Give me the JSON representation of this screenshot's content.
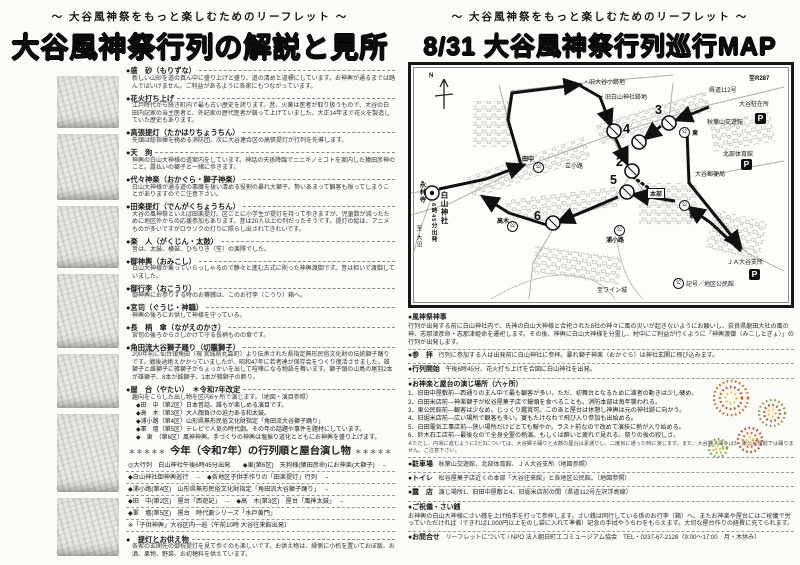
{
  "tagline": "～ 大谷風神祭をもっと楽しむためのリーフレット ～",
  "left_page": {
    "title": "大谷風神祭行列の解説と見所",
    "items": [
      {
        "h": "●盛　砂（もりずな）",
        "b": "新しい山砂を道の真ん中に盛り上げと盛り、道の清めと道標にしています。お神輿が通るまでは踏んではいけません。ご利益があるように各家にもつながっています。"
      },
      {
        "h": "●花火打ち上げ",
        "b": "江戸時代から続き町内で最も古い歴史を誇ります。昔、火薬は医者が取り扱うもので、大谷の白田内記家の当主医者と、外記家の歴代医者が競って上げていました。大正14年まで花火を製造していた歴史もあります。"
      },
      {
        "h": "●高張提灯（たかはりちょうちん）",
        "b": "先頭は総指揮を務める消防団、次に大谷連合区の高張提灯が行列を先導します。"
      },
      {
        "h": "●天　狗",
        "b": "神輿の白山大神様の道案内をしています。神話の天孫降臨でニニギノミコトを案内した猿田彦神のこと。露払いの獅子と一緒に歩きます。"
      },
      {
        "h": "●代々神楽（おかぐら・獅子神楽）",
        "b": "白山大神様が通る道の悪魔を祓い清める役割の暴れ大獅子。勢いあまって観客も祓ってしまうことがありますのでご注意下さい。"
      },
      {
        "h": "●田楽提灯（でんがくちょうちん）",
        "b": "大谷の風神祭といえば田楽提灯。区ごとに小学生が提灯を持って歩きますが、児童数が減ったために地区外からの応援参加もあります。昔は20人以上の列だったそうです。提灯の絵は、アニメものが多いですがロウソクの灯りに照らし出されてきれいです。"
      },
      {
        "h": "●楽　人（がくじん・太鼓）",
        "b": "昔は、太鼓、横笛、ひちりき（笙）の楽隊でした。"
      },
      {
        "h": "●御神輿（おみこし）",
        "b": "白山大神様が乗っていらっしゃるので静々と進む古式に則った神輿渡御です。昔は担いで渡御していました。"
      },
      {
        "h": "●御行李（おこうり）",
        "b": "御神輿にお参りする時のお賽銭は、このお行李（こうり）箱へ。"
      },
      {
        "h": "●宮司（ぐうじ・神職）",
        "b": "神輿の後ろにお供して神様を守っている。"
      },
      {
        "h": "●長　柄　傘（ながえのかさ）",
        "b": "宮司の後ろからさしかけて守る長柄ものの傘です。"
      },
      {
        "h": "●角田流大谷獅子踊り（切籠獅子）",
        "b": "200年前に仙台領角田（現 宮城県丸森町）より伝承された県指定無形民俗文化財の伝統獅子踊りです。戦後途絶えかかっていましたが、昭和47年に若者達が保存会をつくり復活させました。雄獅子と雌獅子に雑獅子がちょっかいを出して喧嘩になる物語を舞います。獅子頭の山鳥の尾羽2本が雄獅子、8本が雌獅子、1本が雑獅子の飾り。"
      },
      {
        "h": "●屋　台（やたい）　＊令和7年改定",
        "b": "趣向をこらした出し物を区内6ヶ所で演じます。（地図・演目参照）"
      }
    ],
    "yatai_lines": [
      "◆田　中（第2区）日本昔話、誰もが楽しめる演目です。",
      "◆高　木（第3区）大人顔負けの迫力ある和太鼓。",
      "◆浦小路（第4区）山形県無形民俗文化財指定「角田流大谷獅子踊り」",
      "◆軍　壇（第5区）テレビで人気の時代劇。その年の話題や事件を題材にしています。",
      "◆　東　（第6区）風神神輿。手づくりの神輿は塩振り道化とともにお神輿を盛り上げます。"
    ],
    "order_section": {
      "stars": "＊＊＊＊＊",
      "title": "今年（令和7年）の行列順と屋台演し物",
      "lines": [
        "◎大行列　白山神社午後6時45分出発　　◆東(第6区)　天狗様(猿田彦命)にお神楽(大獅子)　→",
        "◆白山神社御神輿巡行　→　◆各地区子供手作りの「田楽提灯」行列　→",
        "◆浦小路(第4区)　山形県無形民俗文化財指定「角田流大谷獅子踊り」　→",
        "◆田　中(第2区)　屋台「西遊記」　→　◆高　木(第3区)　屋台「風神太鼓」　→",
        "◆軍　壇(第5区)　屋台　時代劇シリーズ「水戸黄門」",
        "※「子供神輿」大谷区内一巡（午前10時 大谷往来館出発）"
      ]
    },
    "lantern": {
      "h": "●　提灯とお供え物",
      "b": "各家の玄関先の御祝提灯を見て歩くのも楽しいです。お供え物は、縁側に小机を置いておぼ飯、お酒、果物、野菜、お初穂料を供えています。"
    },
    "credits": [
      "■制作/NPO法人朝日町エコミュージアム協会",
      "■絵「平成大谷風神祭絵巻」　作・安藤ゆふみ（※小織）より採取"
    ]
  },
  "right_page": {
    "title": "8/31 大谷風神祭行列巡行MAP",
    "map": {
      "north": "N",
      "p": "P",
      "kou": "公",
      "numbers": [
        "1",
        "2",
        "3",
        "4",
        "5",
        "6"
      ],
      "labels": {
        "old_school": "・旧大谷小跡地",
        "old_shrine": "・旧白山神社跡地",
        "to_r287": "至R287",
        "route112": "県道112号",
        "police": "大谷駐在所",
        "akiba": "秋葉山交遊館",
        "gym": "北部体育館",
        "post": "大谷郵便局",
        "eirinji": "永林寺",
        "tanaka": "田中",
        "tachishoji": "立小路",
        "higashi": "東",
        "takagi": "高木",
        "urakoji": "浦小路",
        "gundan": "軍壇",
        "honbu": "本部",
        "ja": "ＪＡ大谷支所",
        "wine": "至ワイン城",
        "legend": "記号／地区公民館",
        "hakusan": "白山神社",
        "departure": "6時45分出発",
        "to_onuma": "至 大沼"
      }
    },
    "sections": {
      "shinji": {
        "h": "●風神祭神事",
        "b": "行列が出発する前に白山神社内で、氏神の白山大神様と合祀された8社の神々に風の災いが起きないようにお願いし、奈良県龍田大社の風の神、志那津彦命・志那津姫命を遷祀します。その後、神輿に白山大神様を分霊し、村中にご利益が行くように「神輿渡御（みこしとぎょ）」の行列が出発します。"
      },
      "sanpai": {
        "h": "●参　拝",
        "b": "行列に参加する人は出発前に白山神社に参拝。暴れ獅子神楽（おかぐら）は神社玄関に飛び込みます。"
      },
      "kaishi": {
        "h": "●行列開始",
        "b": "午後6時45分、花火打ち上げを合図に白山神社を出発。"
      },
      "places": {
        "h": "●お神楽と屋台の演じ場所（六ヶ所）",
        "list": [
          "1．旧田中屋敷前---西通りのまん中で最も観客が多い。ただ、初舞台となるために演者の動きは少し硬め。",
          "2．白田米店前---神楽獅子が松谷屋菓子店で饅頭を食べることも。消防本部は毎年襲われる。",
          "3．東公民館前---観客は少なめ。じっくり鑑賞可。このあと屋台は休憩し神輿は元の神社跡に向かう。",
          "4．旧堀米店前---広い場所で観客も多い。宴もたけなわで飛び入り参加も出始める。",
          "5．白田電気工事店前---狭い場所だけどとても賑やか。ラスト前なので改めて演技に熱が入り始める。",
          "6．鈴木石工店前---最後なので全身全霊の熱演。もしくは酔いと疲れで見れる。祭りの後の寂しさ。"
        ],
        "note": "※ただし、円滑に進むように2と3については、大谷獅子踊りと太鼓の屋台は素通りし、二度目に通った時に演じます。また、大谷獅子踊りは3．東公民館前では踊りません。ご注意下さい。"
      },
      "parking": {
        "h": "●駐車場",
        "b": "秋葉山交遊館、北部体育館、ＪＡ大谷支所（地図参照）"
      },
      "toilet": {
        "h": "●トイレ",
        "b": "松谷屋菓子店近くの本部「大谷往来館」と各地区公民館。（地図参照）"
      },
      "roten": {
        "h": "●露　店",
        "b": "演じ場所1．旧田中屋敷と4．旧堀米店前の間（県道112号左沢浮島線）"
      },
      "shugi": {
        "h": "●ご祝儀・さい銭",
        "b": "お神輿の白山大神様にさい銭を上げ拍手を打って参拝します。さい銭は同行している係のお行李（箱）へ、またお神楽や屋台にはご祝儀で労っていただければ（できれば1,000円以上をのし袋に入れて準備）記念の手拭やうちわをもらえます。大切な屋台作りの経費に充てられます。"
      },
      "contact": {
        "h": "●お問合せ",
        "b": "リーフレットについて / NPO 法人朝日町エコミュージアム協会　TEL・0237-67-2128（9:00～17:00　月・木休み）"
      }
    },
    "fireworks_colors": {
      "orange": "#e06a1e",
      "yellow": "#eec23a",
      "green": "#7da441",
      "red": "#cf4a22"
    }
  }
}
